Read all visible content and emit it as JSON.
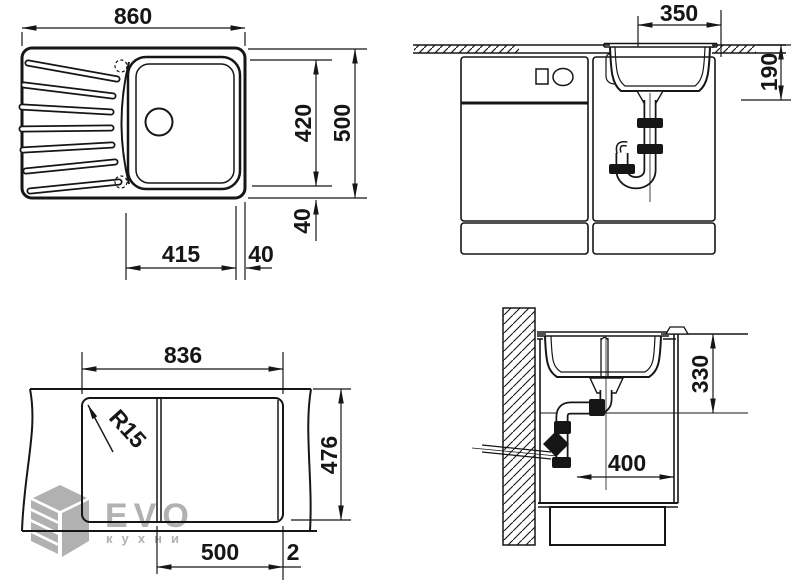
{
  "drawing": {
    "plan_view": {
      "overall_width": "860",
      "overall_depth": "500",
      "bowl_zone_depth": "420",
      "edge_offset_depth": "40",
      "bowl_zone_width": "415",
      "edge_offset_width": "40"
    },
    "front_section": {
      "bowl_width": "350",
      "bowl_depth": "190"
    },
    "cutout_view": {
      "cutout_width": "836",
      "cutout_depth": "476",
      "bowl_section_width": "500",
      "joint_gap": "2",
      "corner_radius": "R15"
    },
    "side_section": {
      "trap_height": "330",
      "drain_offset": "400"
    },
    "watermark": {
      "brand": "EVO",
      "tagline": "кухни"
    },
    "colors": {
      "line": "#161616",
      "watermark_gray": "#b1b1b1"
    }
  }
}
